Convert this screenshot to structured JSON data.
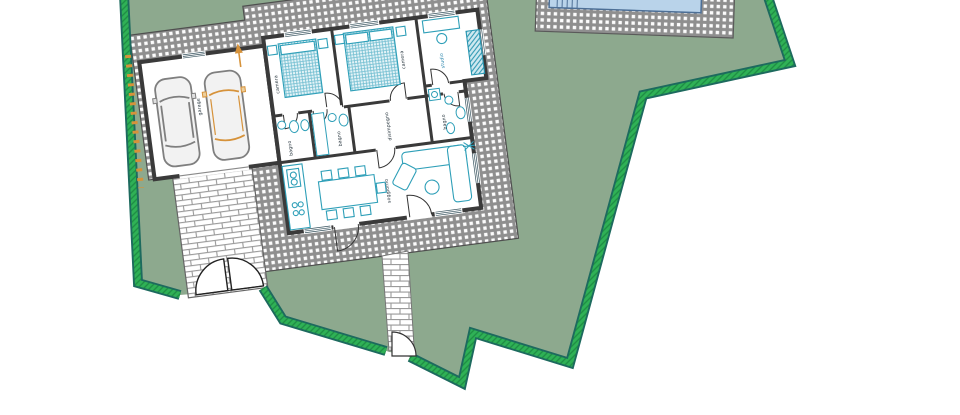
{
  "plan": {
    "type": "residential-site-plan",
    "rooms": [
      {
        "id": "garage",
        "label": "garage"
      },
      {
        "id": "camera-1",
        "label": "camera"
      },
      {
        "id": "camera-2",
        "label": "camera"
      },
      {
        "id": "studio",
        "label": "studio"
      },
      {
        "id": "bagno-1",
        "label": "bagno"
      },
      {
        "id": "bagno-2",
        "label": "bagno"
      },
      {
        "id": "disimpegno",
        "label": "disimpegno"
      },
      {
        "id": "bagno-3",
        "label": "bagno"
      },
      {
        "id": "soggiorno",
        "label": "soggiorno"
      }
    ],
    "features": {
      "pool": "swimming-pool",
      "driveway_gate": "double-swing-gate",
      "pedestrian_gate": "single-swing-gate",
      "north_arrow": "orange-arrow",
      "fence_marks": "orange-dashes",
      "cars_in_garage": 2
    },
    "colors": {
      "lot_green": "#8da98e",
      "boundary_dark": "#1d6a5e",
      "boundary_green": "#2fb156",
      "paving_gray": "#8f8f8f",
      "brick_line": "#9a9a9a",
      "wall_dark": "#3a3a3a",
      "furniture_teal": "#2e9fb8",
      "pool_blue": "#b9d3ea",
      "accent_orange": "#d6923a"
    }
  }
}
